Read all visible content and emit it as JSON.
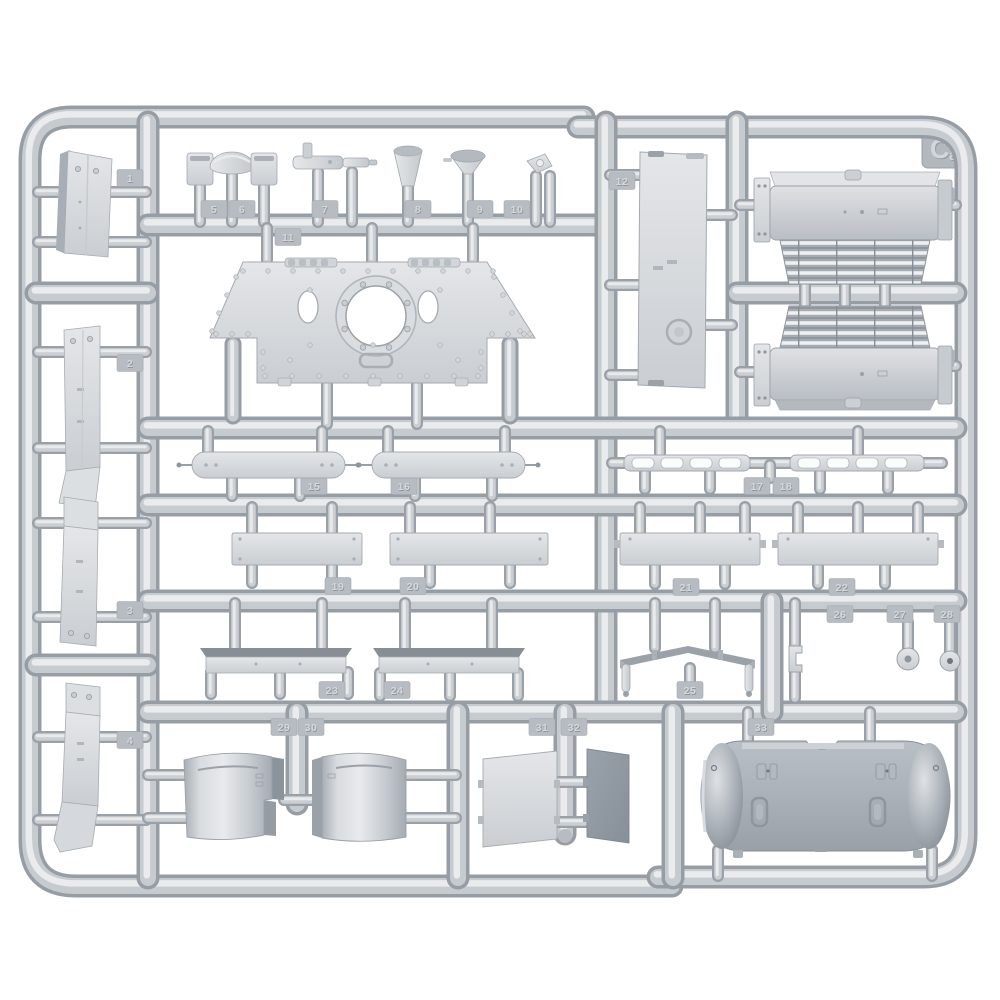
{
  "scene": {
    "description": "Product photograph of a light-gray injection-molded styrene model kit sprue (parts runner) holding unassembled armored-vehicle parts on a white background",
    "background_color": "#ffffff",
    "plastic": {
      "base": "#c6cacf",
      "part_face": "#d8dbde",
      "part_dark": "#9aa1a9",
      "highlight": "#e9ebed",
      "shadow": "#8d939b",
      "tab": "#b7bcc2",
      "tab_digit_light": "#d5d9dc",
      "tab_digit_dark": "#8f959c",
      "tube_edge": "#979da5",
      "tube_mid": "#c6cbd0",
      "tube_highlight": "#e9ebed",
      "gate_edge": "#9aa0a8",
      "gate_mid": "#cbcfd3",
      "gate_highlight": "#e8eaec"
    },
    "sprue": {
      "logo": "Ca",
      "part_number_tabs": [
        {
          "label": "1",
          "x": 130,
          "y": 178
        },
        {
          "label": "2",
          "x": 130,
          "y": 363
        },
        {
          "label": "3",
          "x": 130,
          "y": 610
        },
        {
          "label": "4",
          "x": 130,
          "y": 740
        },
        {
          "label": "5",
          "x": 214,
          "y": 209
        },
        {
          "label": "6",
          "x": 242,
          "y": 209
        },
        {
          "label": "7",
          "x": 325,
          "y": 209
        },
        {
          "label": "8",
          "x": 418,
          "y": 209
        },
        {
          "label": "9",
          "x": 480,
          "y": 209
        },
        {
          "label": "10",
          "x": 517,
          "y": 209
        },
        {
          "label": "11",
          "x": 288,
          "y": 237
        },
        {
          "label": "12",
          "x": 622,
          "y": 181
        },
        {
          "label": "13",
          "x": 941,
          "y": 196
        },
        {
          "label": "14",
          "x": 941,
          "y": 358
        },
        {
          "label": "15",
          "x": 314,
          "y": 486
        },
        {
          "label": "16",
          "x": 404,
          "y": 486
        },
        {
          "label": "17",
          "x": 757,
          "y": 486
        },
        {
          "label": "18",
          "x": 786,
          "y": 486
        },
        {
          "label": "19",
          "x": 338,
          "y": 586
        },
        {
          "label": "20",
          "x": 413,
          "y": 586
        },
        {
          "label": "21",
          "x": 686,
          "y": 587
        },
        {
          "label": "22",
          "x": 842,
          "y": 587
        },
        {
          "label": "23",
          "x": 332,
          "y": 690
        },
        {
          "label": "24",
          "x": 397,
          "y": 690
        },
        {
          "label": "25",
          "x": 690,
          "y": 690
        },
        {
          "label": "26",
          "x": 840,
          "y": 614
        },
        {
          "label": "27",
          "x": 900,
          "y": 614
        },
        {
          "label": "28",
          "x": 947,
          "y": 614
        },
        {
          "label": "29",
          "x": 284,
          "y": 727
        },
        {
          "label": "30",
          "x": 311,
          "y": 727
        },
        {
          "label": "31",
          "x": 542,
          "y": 727
        },
        {
          "label": "32",
          "x": 574,
          "y": 727
        },
        {
          "label": "33",
          "x": 761,
          "y": 727
        }
      ],
      "parts": [
        {
          "name": "mudguard-plate",
          "count": 4,
          "area": "left-column"
        },
        {
          "name": "periscope-guard",
          "count": 2,
          "area": "top-small-parts-row"
        },
        {
          "name": "dome-ventilator-cap",
          "count": 1,
          "area": "top-small-parts-row"
        },
        {
          "name": "cylindrical-fitting",
          "count": 1,
          "area": "top-small-parts-row"
        },
        {
          "name": "stowage-cup",
          "count": 1,
          "area": "top-small-parts-row"
        },
        {
          "name": "funnel-horn",
          "count": 1,
          "area": "top-small-parts-row"
        },
        {
          "name": "angled-bracket",
          "count": 1,
          "area": "top-small-parts-row"
        },
        {
          "name": "turret-roof-plate-with-hatch-ring",
          "count": 1,
          "area": "upper-middle"
        },
        {
          "name": "tall-hull-panel",
          "count": 1,
          "area": "upper-middle-right"
        },
        {
          "name": "louvered-intake-box",
          "count": 2,
          "area": "top-right"
        },
        {
          "name": "rounded-end-skirt-strip",
          "count": 2,
          "area": "row-a-left"
        },
        {
          "name": "segmented-hanger-rail",
          "count": 2,
          "area": "row-a-right"
        },
        {
          "name": "flat-side-strip",
          "count": 4,
          "area": "row-b"
        },
        {
          "name": "beveled-fender-strip",
          "count": 2,
          "area": "row-c-left"
        },
        {
          "name": "cross-support-beam",
          "count": 1,
          "area": "row-c-middle"
        },
        {
          "name": "c-bracket",
          "count": 1,
          "area": "row-c-right"
        },
        {
          "name": "hub-cap-disc",
          "count": 2,
          "area": "row-c-right"
        },
        {
          "name": "curved-shell-panel",
          "count": 2,
          "area": "bottom-left"
        },
        {
          "name": "flat-access-panel-light",
          "count": 1,
          "area": "bottom-middle"
        },
        {
          "name": "flat-access-panel-dark",
          "count": 1,
          "area": "bottom-middle"
        },
        {
          "name": "curved-rear-panel-bulged-ends",
          "count": 1,
          "area": "bottom-right"
        }
      ]
    }
  }
}
